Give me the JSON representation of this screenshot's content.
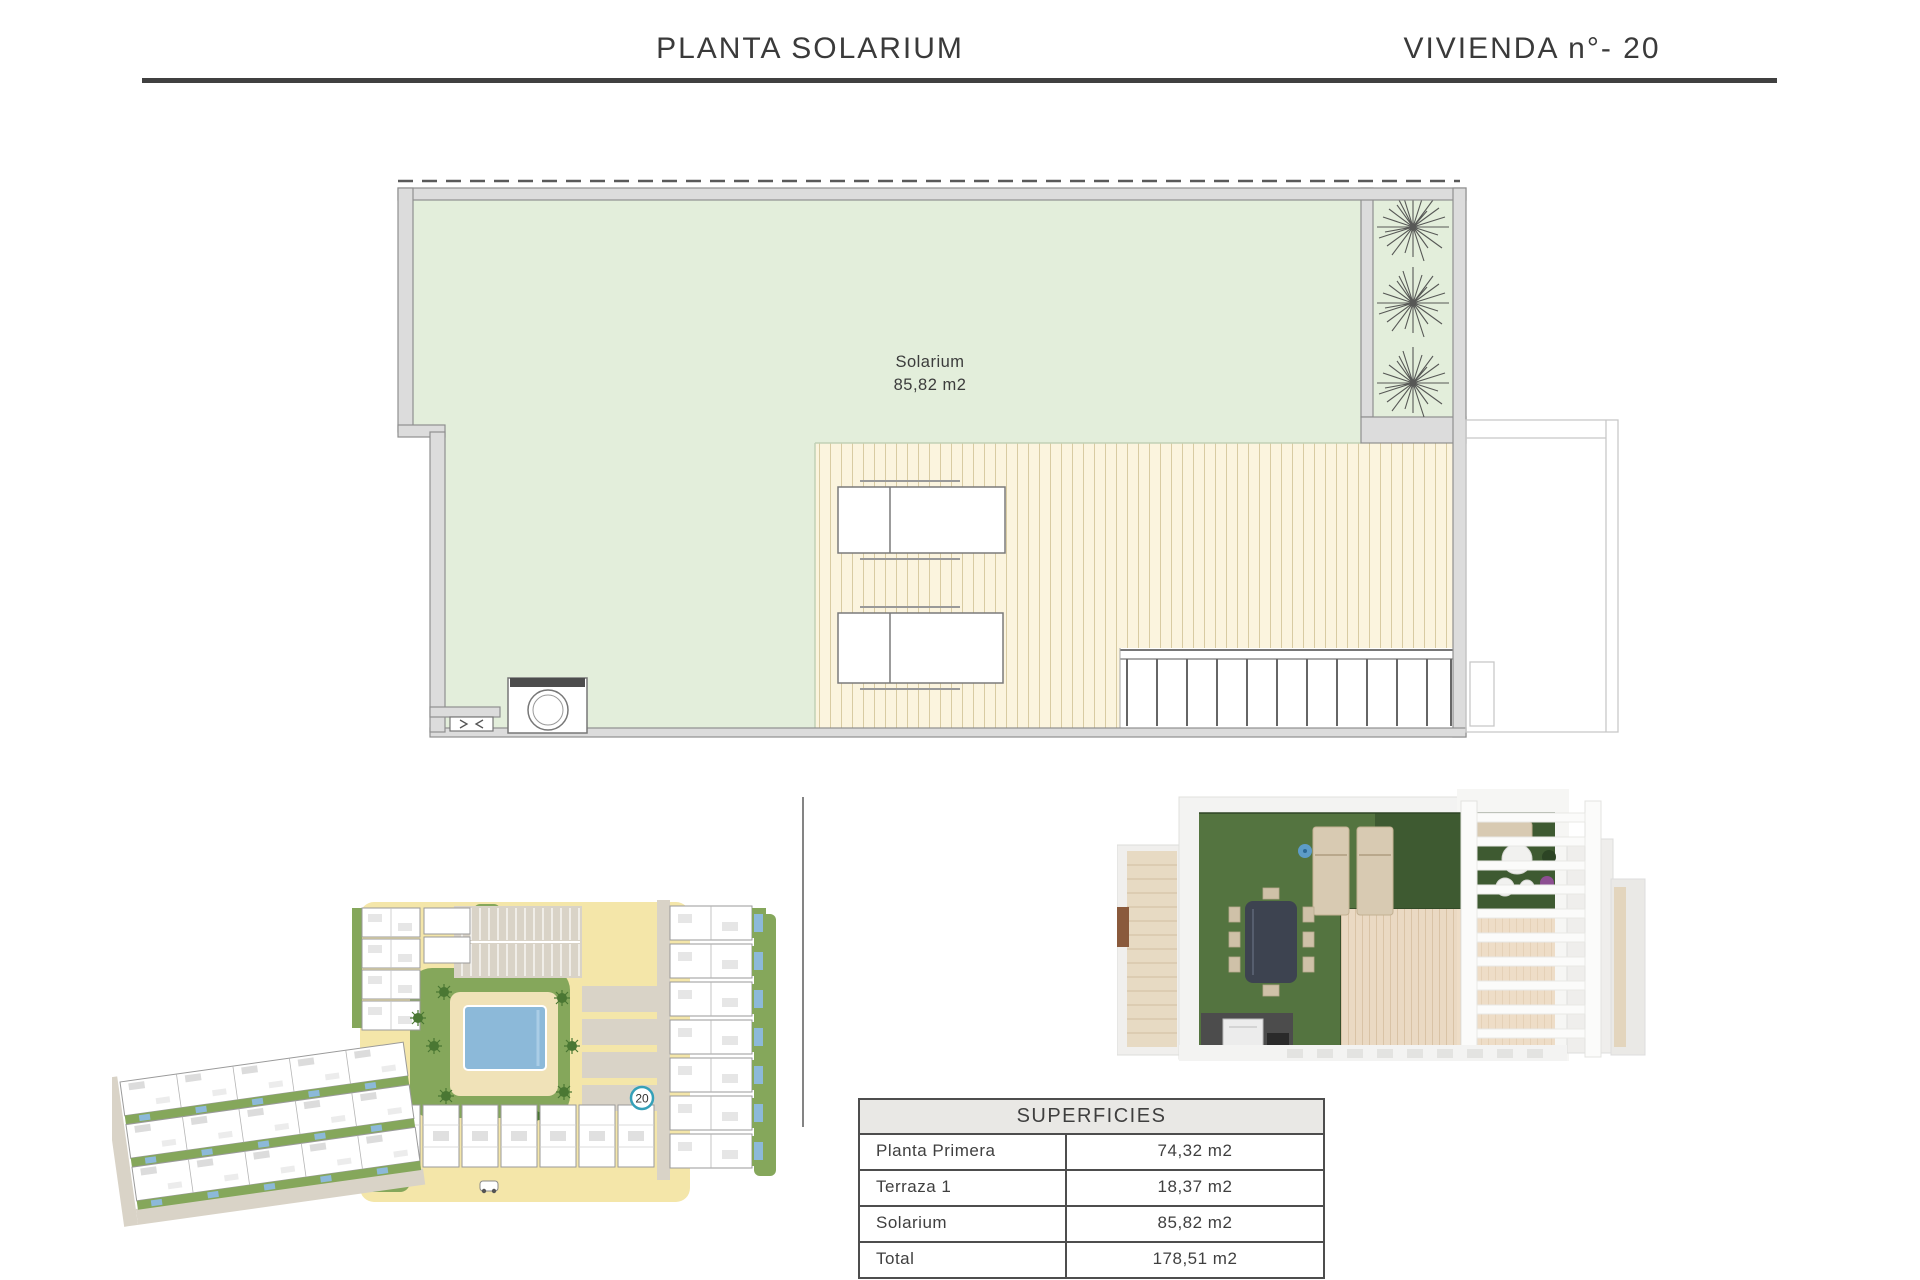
{
  "header": {
    "title_left": "PLANTA SOLARIUM",
    "title_right": "VIVIENDA n°- 20"
  },
  "floor_plan": {
    "room_label": "Solarium",
    "room_area": "85,82 m2",
    "colors": {
      "lawn": "#e3eedb",
      "deck": "#fbf4de",
      "deck_stripe": "#d8cba2",
      "wall_fill": "#dcdcdc",
      "wall_stroke": "#8f8f8f"
    }
  },
  "site_plan": {
    "unit_marker": "20",
    "marker_color": "#35a0b8",
    "colors": {
      "path_yellow": "#f4e6a9",
      "landscape_green": "#85a75b",
      "parking_gray": "#d9d3c7",
      "pool_blue": "#8cb9d9"
    }
  },
  "areas_table": {
    "title": "SUPERFICIES",
    "rows": [
      {
        "label": "Planta Primera",
        "value": "74,32 m2"
      },
      {
        "label": "Terraza 1",
        "value": "18,37 m2"
      },
      {
        "label": "Solarium",
        "value": "85,82 m2"
      },
      {
        "label": "Total",
        "value": "178,51 m2"
      }
    ]
  }
}
